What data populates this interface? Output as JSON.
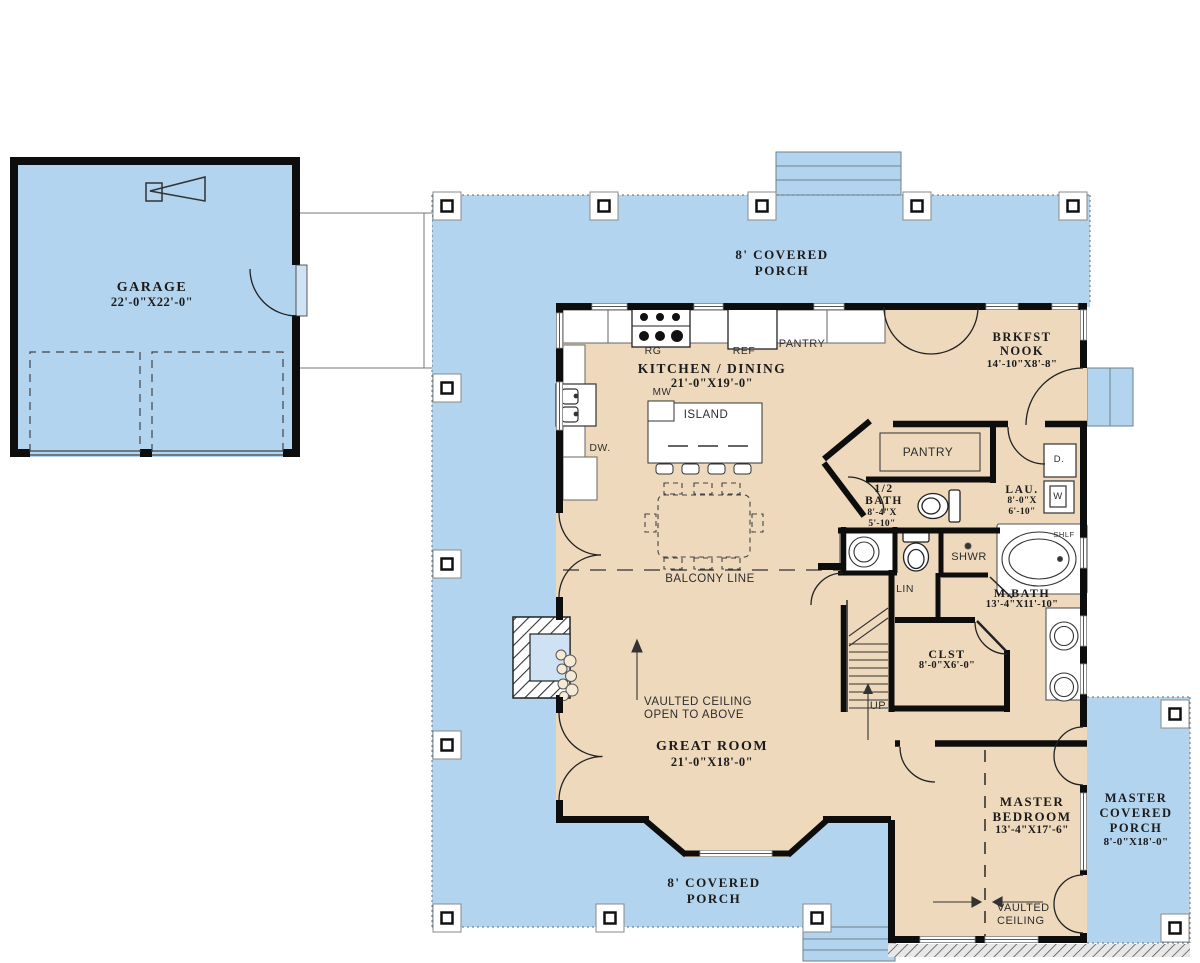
{
  "colors": {
    "porch_blue": "#b2d4ee",
    "floor_tan": "#eed9bc",
    "wall_black": "#0d0d0d",
    "line_gray": "#777777"
  },
  "garage": {
    "name": "GARAGE",
    "dims": "22'-0\"X22'-0\""
  },
  "porches": {
    "top": {
      "l1": "8' COVERED",
      "l2": "PORCH"
    },
    "bottom": {
      "l1": "8' COVERED",
      "l2": "PORCH"
    },
    "master": {
      "l1": "MASTER",
      "l2": "COVERED",
      "l3": "PORCH",
      "dims": "8'-0\"X18'-0\""
    }
  },
  "rooms": {
    "kitchen": {
      "name": "KITCHEN / DINING",
      "dims": "21'-0\"X19'-0\""
    },
    "brkfst": {
      "l1": "BRKFST",
      "l2": "NOOK",
      "dims": "14'-10\"X8'-8\""
    },
    "half_bath": {
      "l1": "1/2",
      "l2": "BATH",
      "dims1": "8'-4\"X",
      "dims2": "5'-10\""
    },
    "laundry": {
      "name": "LAU.",
      "dims1": "8'-0\"X",
      "dims2": "6'-10\""
    },
    "pantry_room": {
      "name": "PANTRY"
    },
    "mbath": {
      "name": "M.BATH",
      "dims": "13'-4\"X11'-10\""
    },
    "closet": {
      "name": "CLST",
      "dims": "8'-0\"X6'-0\""
    },
    "great_room": {
      "name": "GREAT ROOM",
      "dims": "21'-0\"X18'-0\""
    },
    "master_bedroom": {
      "l1": "MASTER",
      "l2": "BEDROOM",
      "dims": "13'-4\"X17'-6\""
    }
  },
  "fixtures": {
    "range": "RG",
    "fridge": "REF",
    "pantry_cabinet": "PANTRY",
    "microwave": "MW",
    "island": "ISLAND",
    "dishwasher": "DW.",
    "shower": "SHWR",
    "shelf": "SHLF",
    "linen": "LIN",
    "dryer": "D.",
    "washer": "W",
    "stairs_up": "UP"
  },
  "annotations": {
    "balcony_line": "BALCONY LINE",
    "vaulted_open1": "VAULTED CEILING",
    "vaulted_open2": "OPEN TO ABOVE",
    "bedroom_vaulted1": "VAULTED",
    "bedroom_vaulted2": "CEILING"
  }
}
